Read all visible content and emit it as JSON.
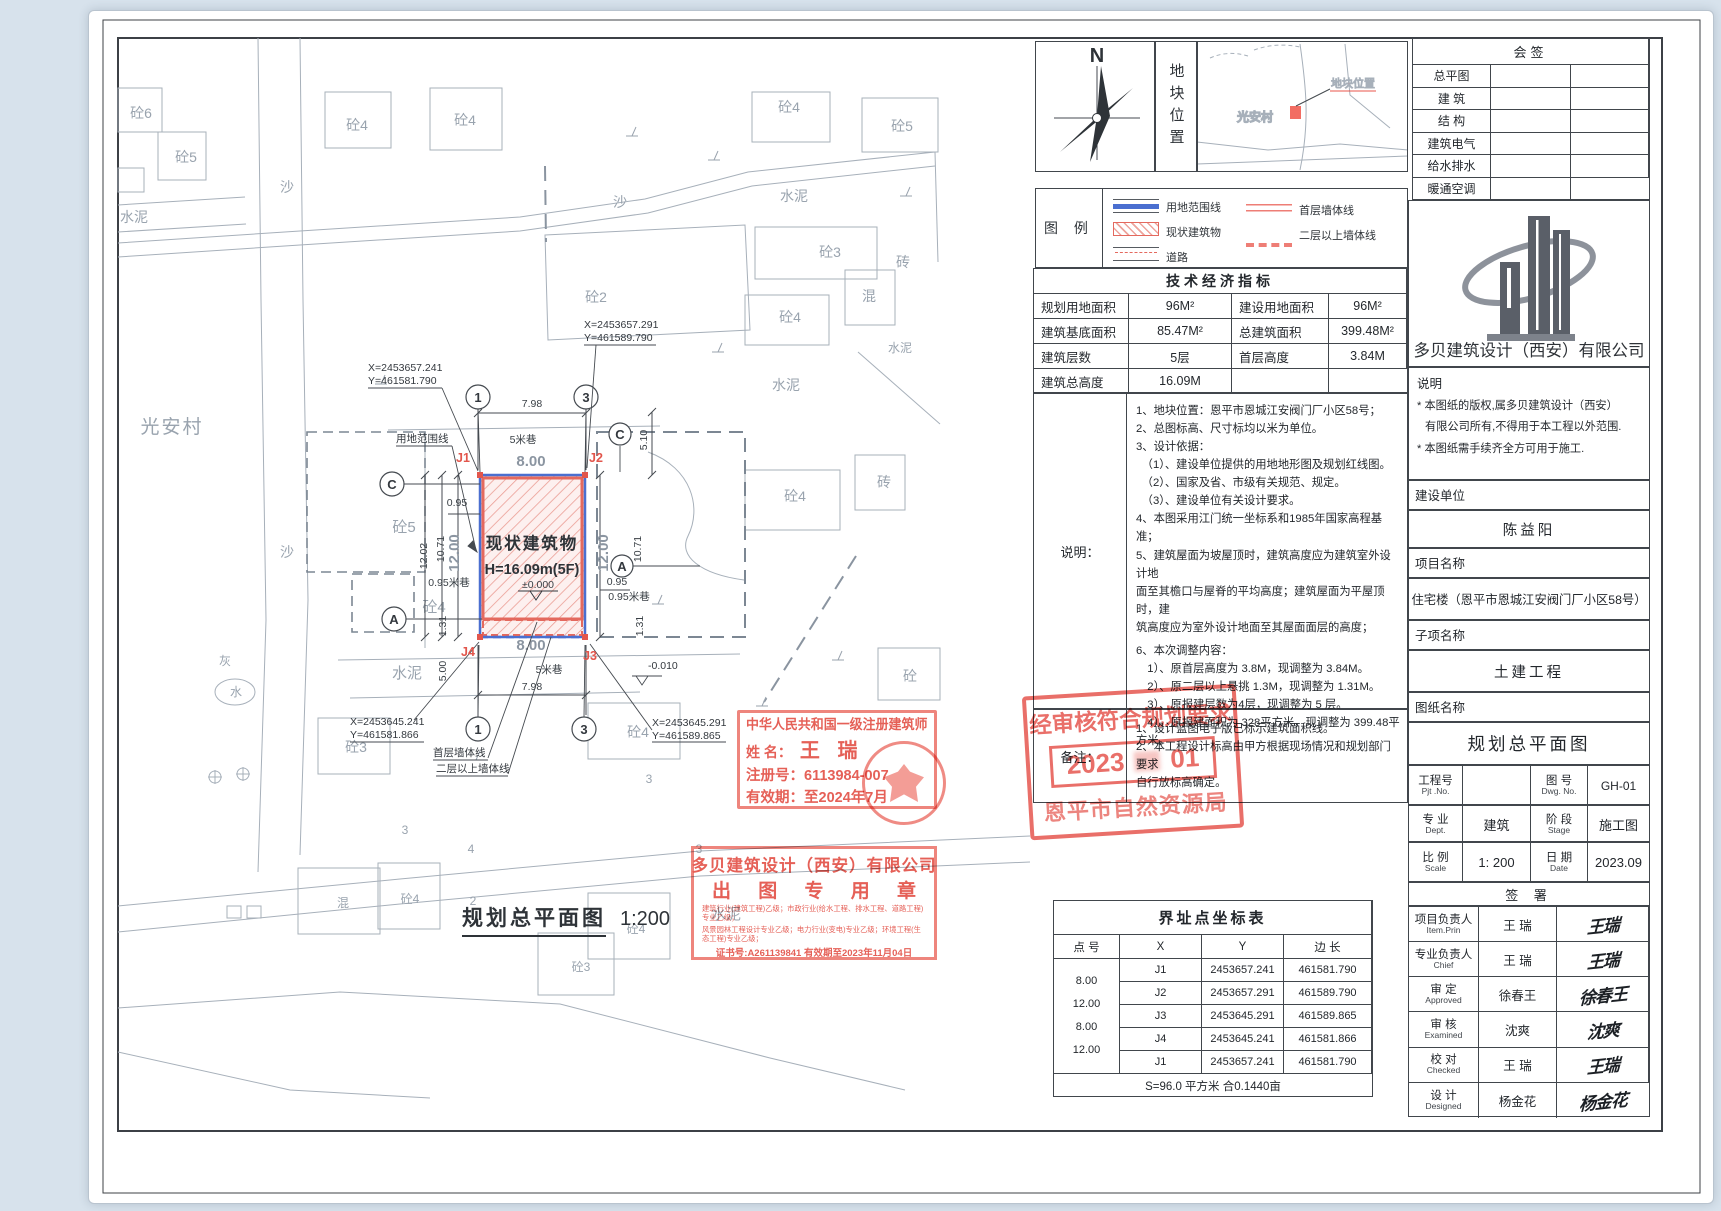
{
  "north": {
    "label": "N"
  },
  "location": {
    "panel_title": "地块位置",
    "village": "光安村",
    "marker_label": "地块位置"
  },
  "legend": {
    "title": "图 例",
    "items": [
      "用地范围线",
      "现状建筑物",
      "道路",
      "首层墙体线",
      "二层以上墙体线"
    ]
  },
  "indicators": {
    "title": "技术经济指标",
    "rows": [
      {
        "l1": "规划用地面积",
        "v1": "96M²",
        "l2": "建设用地面积",
        "v2": "96M²"
      },
      {
        "l1": "建筑基底面积",
        "v1": "85.47M²",
        "l2": "总建筑面积",
        "v2": "399.48M²"
      },
      {
        "l1": "建筑层数",
        "v1": "5层",
        "l2": "首层高度",
        "v2": "3.84M"
      },
      {
        "l1": "建筑总高度",
        "v1": "16.09M",
        "l2": "",
        "v2": ""
      }
    ]
  },
  "notes": {
    "label": "说明：",
    "lines": [
      "1、地块位置：恩平市恩城江安阀门厂小区58号；",
      "2、总图标高、尺寸标均以米为单位。",
      "3、设计依据：",
      "　（1）、建设单位提供的用地地形图及规划红线图。",
      "　（2）、国家及省、市级有关规范、规定。",
      "　（3）、建设单位有关设计要求。",
      "4、本图采用江门统一坐标系和1985年国家高程基准；",
      "5、建筑屋面为坡屋顶时，建筑高度应为建筑室外设计地",
      "面至其檐口与屋脊的平均高度；建筑屋面为平屋顶时，建",
      "筑高度应为室外设计地面至其屋面面层的高度；",
      "6、本次调整内容：",
      "　1）、原首层高度为 3.8M，现调整为 3.84M。",
      "　2）、原二层以上悬挑 1.3M，现调整为 1.31M。",
      "　3）、原报建层数为4层，现调整为 5 层。",
      "　4）、原报建面积为 328平方米，现调整为 399.48平方米。"
    ]
  },
  "remarks": {
    "label": "备注：",
    "lines": [
      "1、设计蓝图电子版已标示建筑面积线。",
      "2、本工程设计标高由甲方根据现场情况和规划部门要求",
      "自行放标高确定。"
    ]
  },
  "coord_table": {
    "title": "界址点坐标表",
    "h_point": "点 号",
    "h_x": "X",
    "h_y": "Y",
    "h_len": "边 长",
    "rows": [
      {
        "p": "J1",
        "x": "2453657.241",
        "y": "461581.790"
      },
      {
        "p": "J2",
        "x": "2453657.291",
        "y": "461589.790"
      },
      {
        "p": "J3",
        "x": "2453645.291",
        "y": "461589.865"
      },
      {
        "p": "J4",
        "x": "2453645.241",
        "y": "461581.866"
      },
      {
        "p": "J1",
        "x": "2453657.241",
        "y": "461581.790"
      }
    ],
    "lengths": [
      "8.00",
      "12.00",
      "8.00",
      "12.00"
    ],
    "footer": "S=96.0 平方米 合0.1440亩"
  },
  "huiqian": {
    "title": "会签",
    "rows": [
      "总平图",
      "建 筑",
      "结 构",
      "建筑电气",
      "给水排水",
      "暖通空调"
    ]
  },
  "company": {
    "name": "多贝建筑设计（西安）有限公司",
    "stmt_title": "说明",
    "stmt1": "* 本图纸的版权,属多贝建筑设计（西安）",
    "stmt2": "有限公司所有,不得用于本工程以外范围.",
    "stmt3": "* 本图纸需手续齐全方可用于施工."
  },
  "title_block": {
    "client_label": "建设单位",
    "client": "陈益阳",
    "project_label": "项目名称",
    "project": "住宅楼（恩平市恩城江安阀门厂小区58号）",
    "sub_label": "子项名称",
    "sub": "土建工程",
    "drawing_label": "图纸名称",
    "drawing": "规划总平面图",
    "pjt_label": "工程号",
    "pjt_label_en": "Pjt .No.",
    "pjt_no": "",
    "dwg_label": "图 号",
    "dwg_label_en": "Dwg. No.",
    "dwg_no": "GH-01",
    "dept_label": "专 业",
    "dept_label_en": "Dept.",
    "dept": "建筑",
    "stage_label": "阶 段",
    "stage_label_en": "Stage",
    "stage": "施工图",
    "scale_label": "比 例",
    "scale_label_en": "Scale",
    "scale": "1: 200",
    "date_label": "日 期",
    "date_label_en": "Date",
    "date": "2023.09",
    "sign_title": "签 署",
    "signers": [
      {
        "role": "项目负责人",
        "role_en": "Item.Prin",
        "name": "王 瑞",
        "sig": "王瑞"
      },
      {
        "role": "专业负责人",
        "role_en": "Chief",
        "name": "王 瑞",
        "sig": "王瑞"
      },
      {
        "role": "审 定",
        "role_en": "Approved",
        "name": "徐春王",
        "sig": "徐春王"
      },
      {
        "role": "审 核",
        "role_en": "Examined",
        "name": "沈爽",
        "sig": "沈爽"
      },
      {
        "role": "校 对",
        "role_en": "Checked",
        "name": "王 瑞",
        "sig": "王瑞"
      },
      {
        "role": "设 计",
        "role_en": "Designed",
        "name": "杨金花",
        "sig": "杨金花"
      }
    ]
  },
  "stamps": {
    "architect": {
      "line1": "中华人民共和国一级注册建筑师",
      "name_label": "姓  名：",
      "name": "王 瑞",
      "reg": "注册号：6113984-007",
      "valid": "有效期：至2024年7月"
    },
    "company_seal": {
      "line1": "多贝建筑设计（西安）有限公司",
      "line2": "出 图 专 用 章",
      "small1": "建筑行业(建筑工程)乙级；市政行业(给水工程、排水工程、道路工程)专业乙级；",
      "small2": "风景园林工程设计专业乙级；电力行业(变电)专业乙级；环境工程(生态工程)专业乙级；",
      "cert": "证书号:A261139841  有效期至2023年11月04日"
    },
    "approval": {
      "line1": "经审核符合规划要求",
      "date_a": "2023",
      "date_b": "01",
      "line3": "恩平市自然资源局"
    }
  },
  "plan": {
    "title": "规划总平面图",
    "scale_text": "1:200",
    "building_name": "现状建筑物",
    "building_height": "H=16.09m(5F)",
    "building_level": "±0.000",
    "level_low": "-0.010",
    "coord_tl_x": "X=2453657.241",
    "coord_tl_y": "Y=461581.790",
    "coord_tr_x": "X=2453657.291",
    "coord_tr_y": "Y=461589.790",
    "coord_bl_x": "X=2453645.241",
    "coord_bl_y": "Y=461581.866",
    "coord_br_x": "X=2453645.291",
    "coord_br_y": "Y=461589.865",
    "j1": "J1",
    "j2": "J2",
    "j3": "J3",
    "j4": "J4",
    "axis_1": "1",
    "axis_3": "3",
    "axis_c": "C",
    "axis_a": "A",
    "callout_boundary": "用地范围线",
    "callout_first_wall": "首层墙体线",
    "callout_upper_wall": "二层以上墙体线",
    "dim_798": "7.98",
    "dim_800": "8.00",
    "lane_5": "5米巷",
    "dim_1200": "12.00",
    "dim_1202": "12.02",
    "dim_1071": "10.71",
    "dim_095": "0.95",
    "lane_095": "0.95米巷",
    "dim_131": "1.31",
    "dim_510": "5.10",
    "dim_500": "5.00",
    "ctx": [
      "砼6",
      "砼5",
      "水泥",
      "沙",
      "砼4",
      "砼4",
      "沙",
      "砼4",
      "砼5",
      "水泥",
      "砼3",
      "砼2",
      "砼4",
      "混",
      "砖",
      "水泥",
      "水泥",
      "光安村",
      "沙",
      "砼5",
      "砼4",
      "砼4",
      "砖",
      "灰",
      "水",
      "砼",
      "砼3",
      "砼4",
      "水泥",
      "水泥",
      "3",
      "3",
      "4",
      "3",
      "混",
      "砼4",
      "2",
      "砼4",
      "砼3"
    ]
  }
}
